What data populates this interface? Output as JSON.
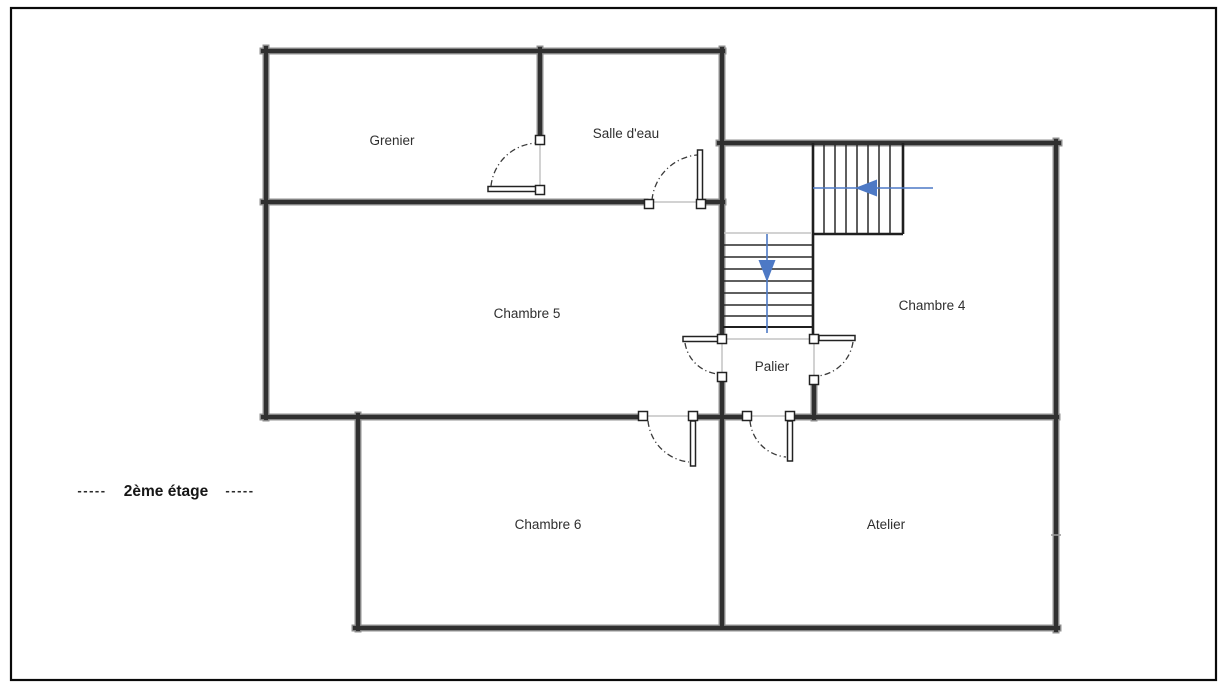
{
  "floor_plan": {
    "type": "architectural-floor-plan",
    "floor_label": {
      "left_dashes": "-----",
      "text": "2ème étage",
      "right_dashes": "-----"
    },
    "rooms": [
      {
        "label": "Grenier"
      },
      {
        "label": "Salle d'eau"
      },
      {
        "label": "Chambre 5"
      },
      {
        "label": "Chambre 4"
      },
      {
        "label": "Palier"
      },
      {
        "label": "Chambre 6"
      },
      {
        "label": "Atelier"
      }
    ],
    "stairs": {
      "upper_run_arrow_direction": "left",
      "lower_run_arrow_direction": "down",
      "arrow_color": "#4d79c5"
    },
    "colors": {
      "wall_core": "#303030",
      "wall_edge": "#909090",
      "stair_outline": "#1f1f1f",
      "stair_tread": "#2a2a2a",
      "opening_line": "#c4c4c4",
      "door_arc": "#3a3a3a",
      "text": "#2f2f2f",
      "page_border": "#0a0a0a",
      "background": "#ffffff"
    }
  }
}
